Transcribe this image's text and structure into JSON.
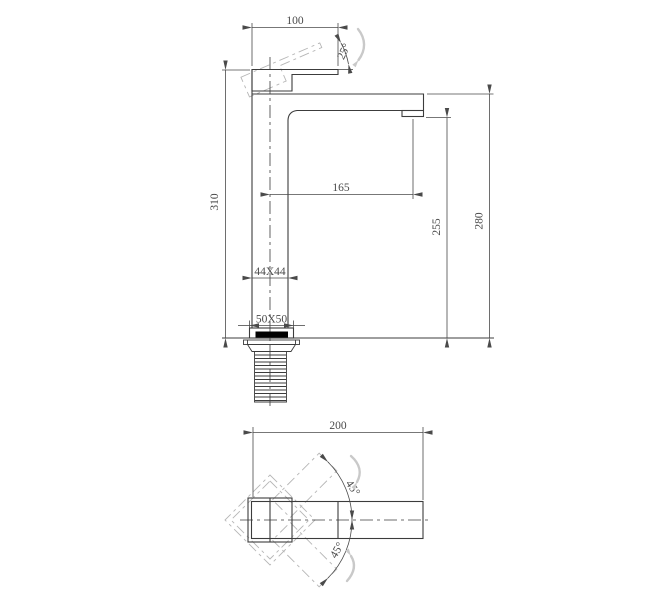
{
  "front_view": {
    "handle_length": "100",
    "handle_angle": "25°",
    "total_height": "310",
    "spout_reach": "165",
    "outlet_height": "255",
    "spout_top_height": "280",
    "body_section": "44X44",
    "base_section": "50X50"
  },
  "top_view": {
    "overall_length": "200",
    "handle_swing_upper": "45°",
    "handle_swing_lower": "45°"
  },
  "colors": {
    "line_color": "#3c3c3c",
    "dim_color": "#4a4a4a",
    "phantom_color": "#b6b6b6",
    "swoosh_color": "#c9c9c9",
    "accent_black": "#000000",
    "background": "#ffffff"
  }
}
